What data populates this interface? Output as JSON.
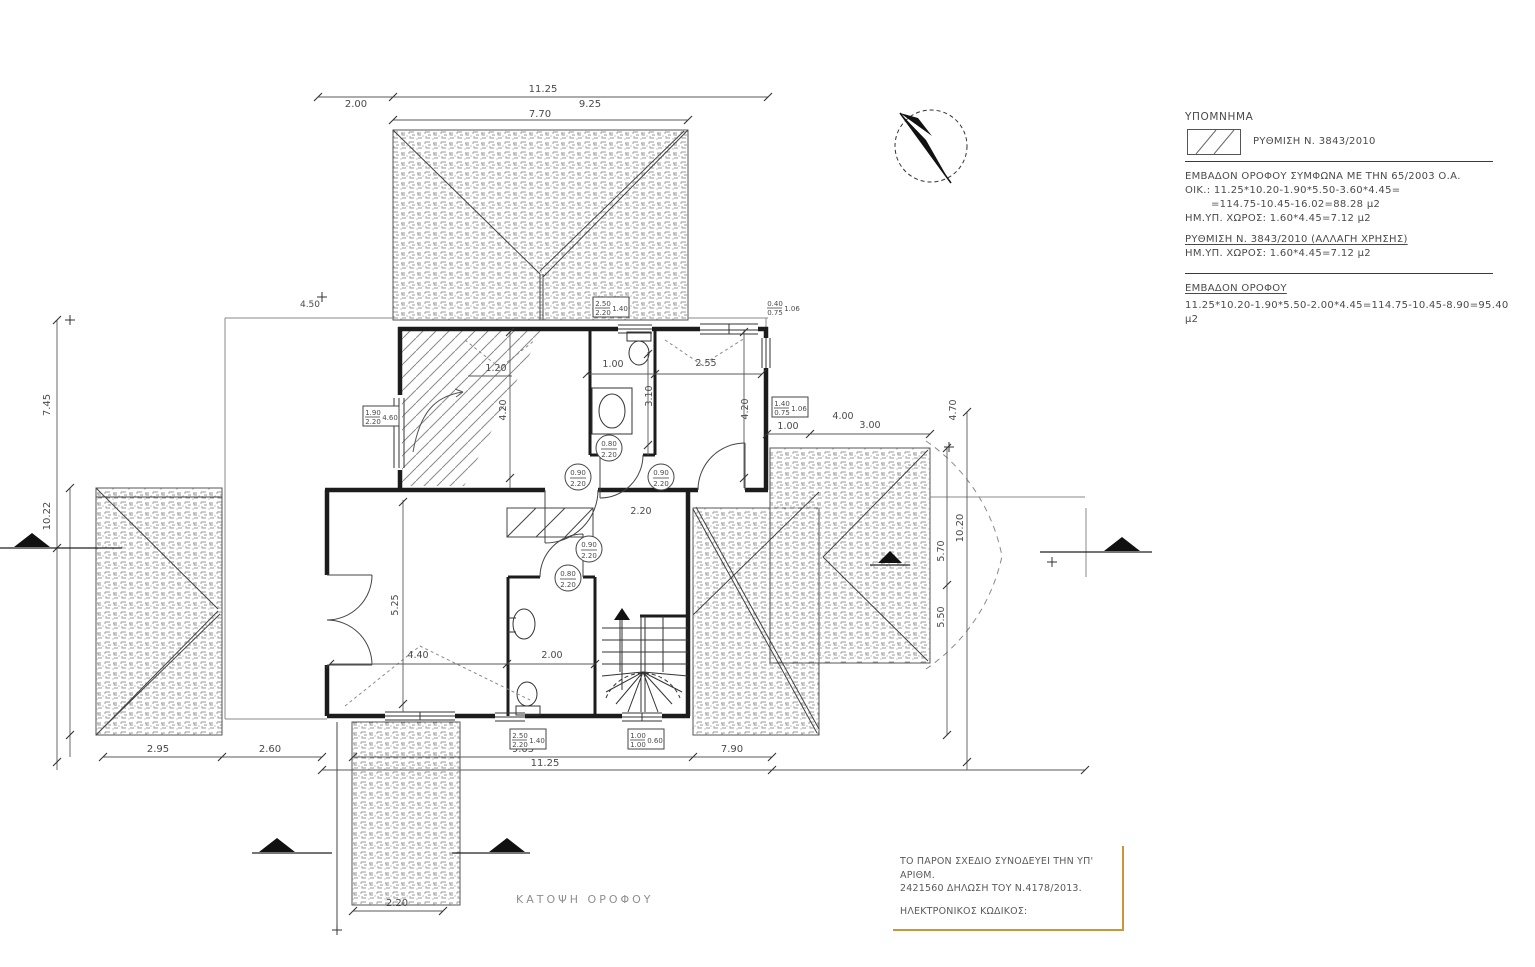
{
  "drawing": {
    "title": "ΚΑΤΟΨΗ  ΟΡΟΦΟΥ"
  },
  "legend": {
    "title": "ΥΠΟΜΝΗΜΑ",
    "swatch_icon": "diagonal-hatch-swatch",
    "swatch_label": "ΡΥΘΜΙΣΗ Ν. 3843/2010"
  },
  "notes": {
    "area_line1": "ΕΜΒΑΔΟΝ ΟΡΟΦΟΥ ΣΥΜΦΩΝΑ ΜΕ ΤΗΝ 65/2003 Ο.Α.",
    "area_line2": "ΟΙΚ.: 11.25*10.20-1.90*5.50-3.60*4.45=",
    "area_line3": "=114.75-10.45-16.02=88.28 μ2",
    "area_line4": "ΗΜ.ΥΠ. ΧΩΡΟΣ: 1.60*4.45=7.12 μ2",
    "reg_title": "ΡΥΘΜΙΣΗ Ν. 3843/2010 (ΑΛΛΑΓΗ ΧΡΗΣΗΣ)",
    "reg_line": "ΗΜ.ΥΠ. ΧΩΡΟΣ: 1.60*4.45=7.12 μ2",
    "total_title": "ΕΜΒΑΔΟΝ ΟΡΟΦΟΥ",
    "total_line": "11.25*10.20-1.90*5.50-2.00*4.45=114.75-10.45-8.90=95.40 μ2"
  },
  "declaration": {
    "line1": "ΤΟ ΠΑΡΟΝ ΣΧΕΔΙΟ ΣΥΝΟΔΕΥΕΙ ΤΗΝ ΥΠ' ΑΡΙΘΜ.",
    "line2": "2421560 ΔΗΛΩΣΗ ΤΟΥ Ν.4178/2013.",
    "line3": "ΗΛΕΚΤΡΟΝΙΚΟΣ ΚΩΔΙΚΟΣ:",
    "border_color": "#c9973b"
  },
  "colors": {
    "line": "#2a2a2a",
    "dim": "#4a4a4a",
    "texture": "#9a9a9a",
    "hatch": "#8a8a8a",
    "accent": "#c9973b"
  },
  "north_arrow": {
    "icon": "north-arrow-icon"
  },
  "plan": {
    "dim_labels": [
      {
        "t": "11.25",
        "x": 543,
        "y": 92
      },
      {
        "t": "2.00",
        "x": 356,
        "y": 107
      },
      {
        "t": "9.25",
        "x": 590,
        "y": 107
      },
      {
        "t": "7.70",
        "x": 540,
        "y": 117
      },
      {
        "t": "4.50",
        "x": 310,
        "y": 307,
        "s": 9
      },
      {
        "t": "1.20",
        "x": 496,
        "y": 371,
        "s": 9.5
      },
      {
        "t": "1.00",
        "x": 613,
        "y": 367,
        "s": 9.5
      },
      {
        "t": "2.55",
        "x": 706,
        "y": 366,
        "s": 9.5
      },
      {
        "t": "3.10",
        "x": 652,
        "y": 396,
        "r": -90,
        "s": 9.5
      },
      {
        "t": "4.20",
        "x": 506,
        "y": 410,
        "r": -90,
        "s": 9.5
      },
      {
        "t": "4.20",
        "x": 748,
        "y": 409,
        "r": -90,
        "s": 9.5
      },
      {
        "t": "1.00",
        "x": 788,
        "y": 429,
        "s": 9.5
      },
      {
        "t": "3.00",
        "x": 870,
        "y": 428,
        "s": 9.5
      },
      {
        "t": "4.00",
        "x": 843,
        "y": 419,
        "s": 9.5
      },
      {
        "t": "5.25",
        "x": 398,
        "y": 605,
        "r": -90,
        "s": 9.5
      },
      {
        "t": "4.40",
        "x": 418,
        "y": 658,
        "s": 9.5
      },
      {
        "t": "2.00",
        "x": 552,
        "y": 658,
        "s": 9.5
      },
      {
        "t": "2.20",
        "x": 641,
        "y": 514,
        "s": 9.5
      },
      {
        "t": "2.95",
        "x": 158,
        "y": 752
      },
      {
        "t": "2.60",
        "x": 270,
        "y": 752
      },
      {
        "t": "9.05",
        "x": 523,
        "y": 752
      },
      {
        "t": "11.25",
        "x": 545,
        "y": 766
      },
      {
        "t": "7.90",
        "x": 732,
        "y": 752
      },
      {
        "t": "2.20",
        "x": 397,
        "y": 906
      },
      {
        "t": "7.45",
        "x": 50,
        "y": 405,
        "r": -90
      },
      {
        "t": "10.22",
        "x": 50,
        "y": 516,
        "r": -90
      },
      {
        "t": "4.70",
        "x": 956,
        "y": 410,
        "r": -90,
        "s": 9.5
      },
      {
        "t": "10.20",
        "x": 963,
        "y": 528,
        "r": -90
      },
      {
        "t": "5.70",
        "x": 944,
        "y": 551,
        "r": -90,
        "s": 9.5
      },
      {
        "t": "5.50",
        "x": 944,
        "y": 617,
        "r": -90,
        "s": 9.5
      }
    ],
    "door_specs": [
      {
        "top": "0.80",
        "bot": "2.20",
        "x": 609,
        "y": 448
      },
      {
        "top": "0.90",
        "bot": "2.20",
        "x": 578,
        "y": 477
      },
      {
        "top": "0.90",
        "bot": "2.20",
        "x": 661,
        "y": 477
      },
      {
        "top": "0.90",
        "bot": "2.20",
        "x": 589,
        "y": 549
      },
      {
        "top": "0.80",
        "bot": "2.20",
        "x": 568,
        "y": 578
      }
    ],
    "window_specs": [
      {
        "top": "2.50",
        "bot": "2.20",
        "side": "1.40",
        "x": 611,
        "y": 307,
        "boxed": true
      },
      {
        "top": "0.40",
        "bot": "0.75",
        "side": "1.06",
        "x": 783,
        "y": 307,
        "boxed": false
      },
      {
        "top": "1.90",
        "bot": "2.20",
        "side": "4.60",
        "x": 381,
        "y": 416,
        "boxed": true
      },
      {
        "top": "1.40",
        "bot": "0.75",
        "side": "1.06",
        "x": 790,
        "y": 407,
        "boxed": true
      },
      {
        "top": "2.50",
        "bot": "2.20",
        "side": "1.40",
        "x": 528,
        "y": 739,
        "boxed": true
      },
      {
        "top": "1.00",
        "bot": "1.00",
        "side": "0.60",
        "x": 646,
        "y": 739,
        "boxed": true
      }
    ]
  }
}
